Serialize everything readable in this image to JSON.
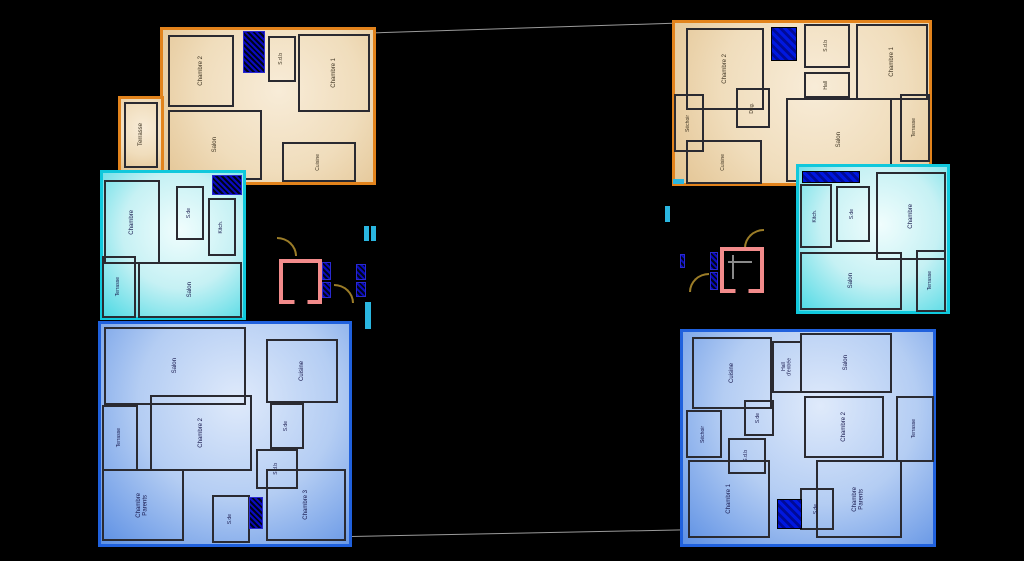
{
  "drawing": {
    "type": "architectural-floor-plan",
    "description": "Two building wings, each with three apartment units stacked (orange top, cyan middle, blue bottom), twin elevator/stair cores between them",
    "colors": {
      "background": "#000000",
      "orange_unit_border": "#E2831C",
      "cyan_unit_border": "#10C8DC",
      "blue_unit_border": "#2061DD",
      "elevator_shaft": "#F28B8B",
      "stair_symbol": "#9C7D28",
      "duct_shaft": "#0A0AC0",
      "survey_line": "#9A9A9A"
    }
  },
  "left": {
    "orange": {
      "terrasse": "Terrasse",
      "chambre2": "Chambre 2",
      "sdb": "S.d.b",
      "chambre1": "Chambre 1",
      "salon": "Salon",
      "cuisine": "Cuisine"
    },
    "cyan": {
      "chambre": "Chambre",
      "sde": "S.de",
      "kitch": "Kitch.",
      "terrasse": "Terrasse",
      "salon": "Salon"
    },
    "blue": {
      "salon": "Salon",
      "cuisine": "Cuisine",
      "terrasse": "Terrasse",
      "chambre2": "Chambre 2",
      "sde": "S.de",
      "sdb": "S.d.b",
      "chambre_parents": "Chambre\nParents",
      "chambre3": "Chambre 3",
      "sde2": "S.de"
    }
  },
  "right": {
    "orange": {
      "chambre2": "Chambre 2",
      "sdb": "S.d.b",
      "hall": "Hall",
      "chambre1": "Chambre 1",
      "sechoir": "Séchoir",
      "deg": "Dég.",
      "cuisine": "Cuisine",
      "salon": "Salon",
      "terrasse": "Terrasse"
    },
    "cyan": {
      "kitch": "Kitch.",
      "sde": "S.de",
      "chambre": "Chambre",
      "salon": "Salon",
      "terrasse": "Terrasse"
    },
    "blue": {
      "cuisine": "Cuisine",
      "hall_entree": "Hall\nd'entrée",
      "salon": "Salon",
      "chambre2": "Chambre 2",
      "terrasse": "Terrasse",
      "sechoir": "Séchoir",
      "sde": "S.de",
      "sdb": "S.d.b",
      "chambre1": "Chambre 1",
      "chambre_parents": "Chambre\nParents",
      "sde2": "S.de"
    }
  }
}
